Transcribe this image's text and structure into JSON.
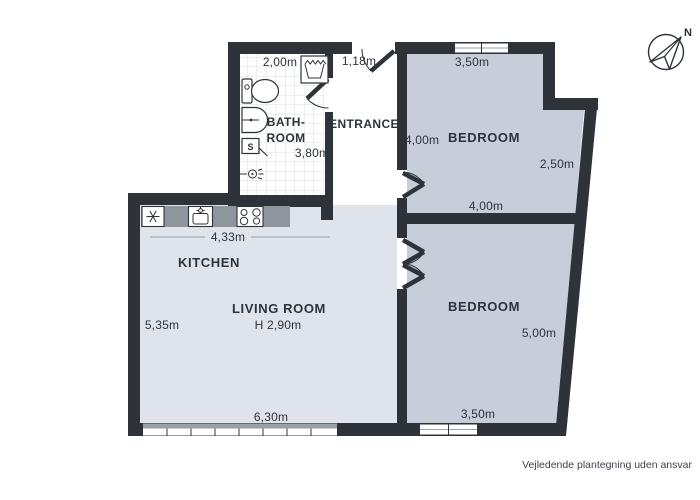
{
  "page": {
    "footer_disclaimer": "Vejledende plantegning uden ansvar"
  },
  "compass": {
    "label_north": "N"
  },
  "colors": {
    "wall": "#2e333a",
    "bedroom_fill": "#c7cdd9",
    "living_fill": "#dfe4eb",
    "counter": "#8e959d",
    "tile_line": "#dcdfe3",
    "dim_line": "#9aa0a8",
    "text": "#2e333a"
  },
  "rooms": {
    "bathroom": {
      "label_line1": "BATH-",
      "label_line2": "ROOM",
      "width_dim": "2,00m",
      "length_dim": "3,80m",
      "shower_label": "S",
      "fixtures": [
        "toilet-icon",
        "washing-machine-icon",
        "washbasin-icon",
        "shower-box-icon",
        "floor-drain-icon"
      ]
    },
    "entrance": {
      "label": "ENTRANCE",
      "door_width_dim": "1,18m"
    },
    "bedroom1": {
      "label": "BEDROOM",
      "top_dim": "3,50m",
      "left_dim": "4,00m",
      "right_dim": "2,50m",
      "bottom_dim": "4,00m"
    },
    "bedroom2": {
      "label": "BEDROOM",
      "right_dim": "5,00m",
      "bottom_dim": "3,50m"
    },
    "kitchen": {
      "label": "KITCHEN",
      "counter_dim": "4,33m",
      "appliances": [
        "fridge-icon",
        "kitchen-sink-icon",
        "stove-icon"
      ]
    },
    "living_room": {
      "label": "LIVING ROOM",
      "ceiling_height": "H 2,90m",
      "left_dim": "5,35m",
      "bottom_dim": "6,30m"
    }
  }
}
